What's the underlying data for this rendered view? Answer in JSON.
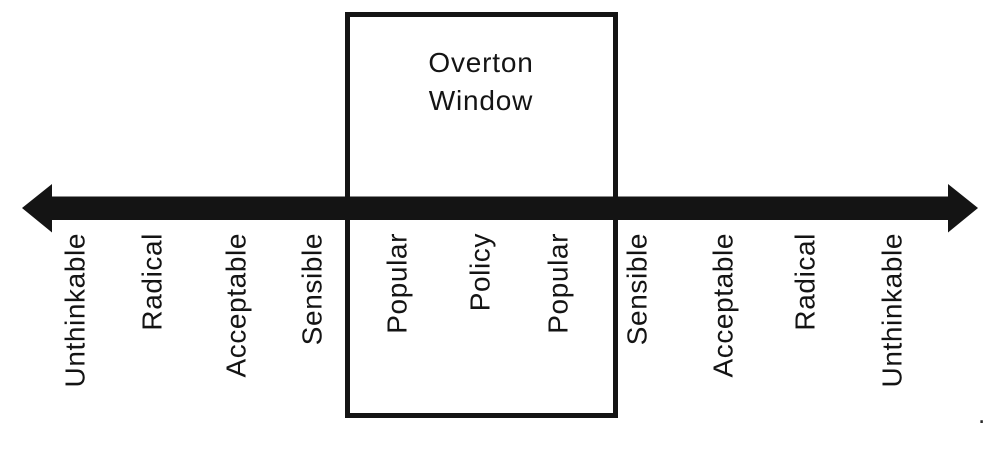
{
  "diagram": {
    "title": {
      "line1": "Overton",
      "line2": "Window"
    },
    "labels": [
      "Unthinkable",
      "Radical",
      "Acceptable",
      "Sensible",
      "Popular",
      "Policy",
      "Popular",
      "Sensible",
      "Acceptable",
      "Radical",
      "Unthinkable"
    ],
    "stray_mark": ".",
    "colors": {
      "ink": "#141414",
      "background": "#ffffff"
    }
  }
}
